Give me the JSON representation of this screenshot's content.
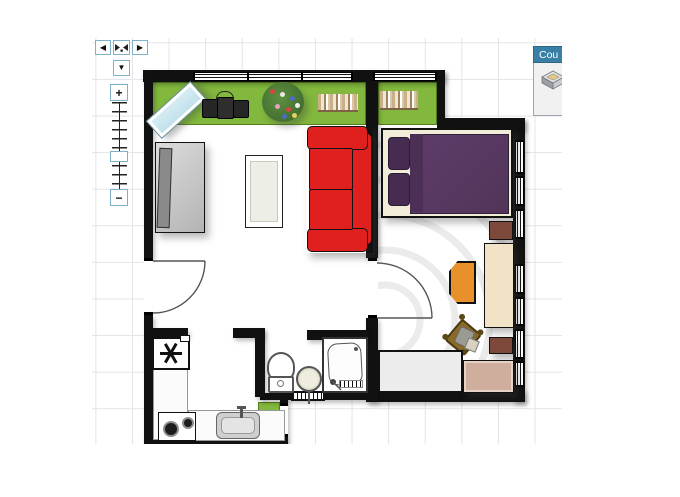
{
  "app": {
    "name": "floorplan-editor-canvas",
    "background": "#ffffff",
    "grid_color": "#e3e4e8"
  },
  "controls": {
    "pan_left_glyph": "◀",
    "pan_right_glyph": "▶",
    "pan_down_glyph": "▼",
    "center_icon": "fit-view-icon",
    "zoom_in_glyph": "+",
    "zoom_out_glyph": "−",
    "border_accent": "#7fb2c8"
  },
  "tooltip": {
    "title": "Cou",
    "header_color": "#3a80a6",
    "thumbnail_icon": "sofa-3d-thumbnail"
  },
  "palette": {
    "wall": "#111111",
    "balcony_green": "#82b83d",
    "sofa_red": "#e01f1f",
    "bed_duvet_purple": "#583963",
    "bed_pillow_purple": "#472c52",
    "bed_frame_cream": "#f2edd9",
    "lounger_blue": "#cfe9f1",
    "chair_orange": "#e8912a",
    "desk_tan": "#f3e3c6",
    "dresser_tan": "#cfae9d",
    "nightstand_brown": "#7d493a",
    "cabinet_gray": "#ececec",
    "sideboard_gray": "#cccccc",
    "tv_gray": "#8a8a8a"
  },
  "floorplan": {
    "rooms": [
      "living-room",
      "bedroom",
      "bathroom",
      "kitchen",
      "balcony"
    ],
    "furniture": [
      {
        "room": "balcony",
        "item": "sun-lounger"
      },
      {
        "room": "balcony",
        "item": "storage-boxes"
      },
      {
        "room": "balcony",
        "item": "flowering-plant"
      },
      {
        "room": "balcony",
        "item": "book-row"
      },
      {
        "room": "balcony",
        "item": "book-row"
      },
      {
        "room": "living-room",
        "item": "tv-sideboard"
      },
      {
        "room": "living-room",
        "item": "coffee-table"
      },
      {
        "room": "living-room",
        "item": "red-sofa"
      },
      {
        "room": "bedroom",
        "item": "double-bed"
      },
      {
        "room": "bedroom",
        "item": "nightstand"
      },
      {
        "room": "bedroom",
        "item": "desk"
      },
      {
        "room": "bedroom",
        "item": "orange-chair"
      },
      {
        "room": "bedroom",
        "item": "wooden-chair"
      },
      {
        "room": "bedroom",
        "item": "nightstand"
      },
      {
        "room": "bedroom",
        "item": "dresser"
      },
      {
        "room": "bedroom",
        "item": "low-cabinet"
      },
      {
        "room": "bedroom",
        "item": "round-rug"
      },
      {
        "room": "bathroom",
        "item": "toilet"
      },
      {
        "room": "bathroom",
        "item": "washbasin"
      },
      {
        "room": "bathroom",
        "item": "shower"
      },
      {
        "room": "bathroom",
        "item": "radiator"
      },
      {
        "room": "kitchen",
        "item": "fridge"
      },
      {
        "room": "kitchen",
        "item": "counter"
      },
      {
        "room": "kitchen",
        "item": "cooktop"
      },
      {
        "room": "kitchen",
        "item": "sink"
      },
      {
        "room": "kitchen",
        "item": "planter"
      }
    ]
  }
}
